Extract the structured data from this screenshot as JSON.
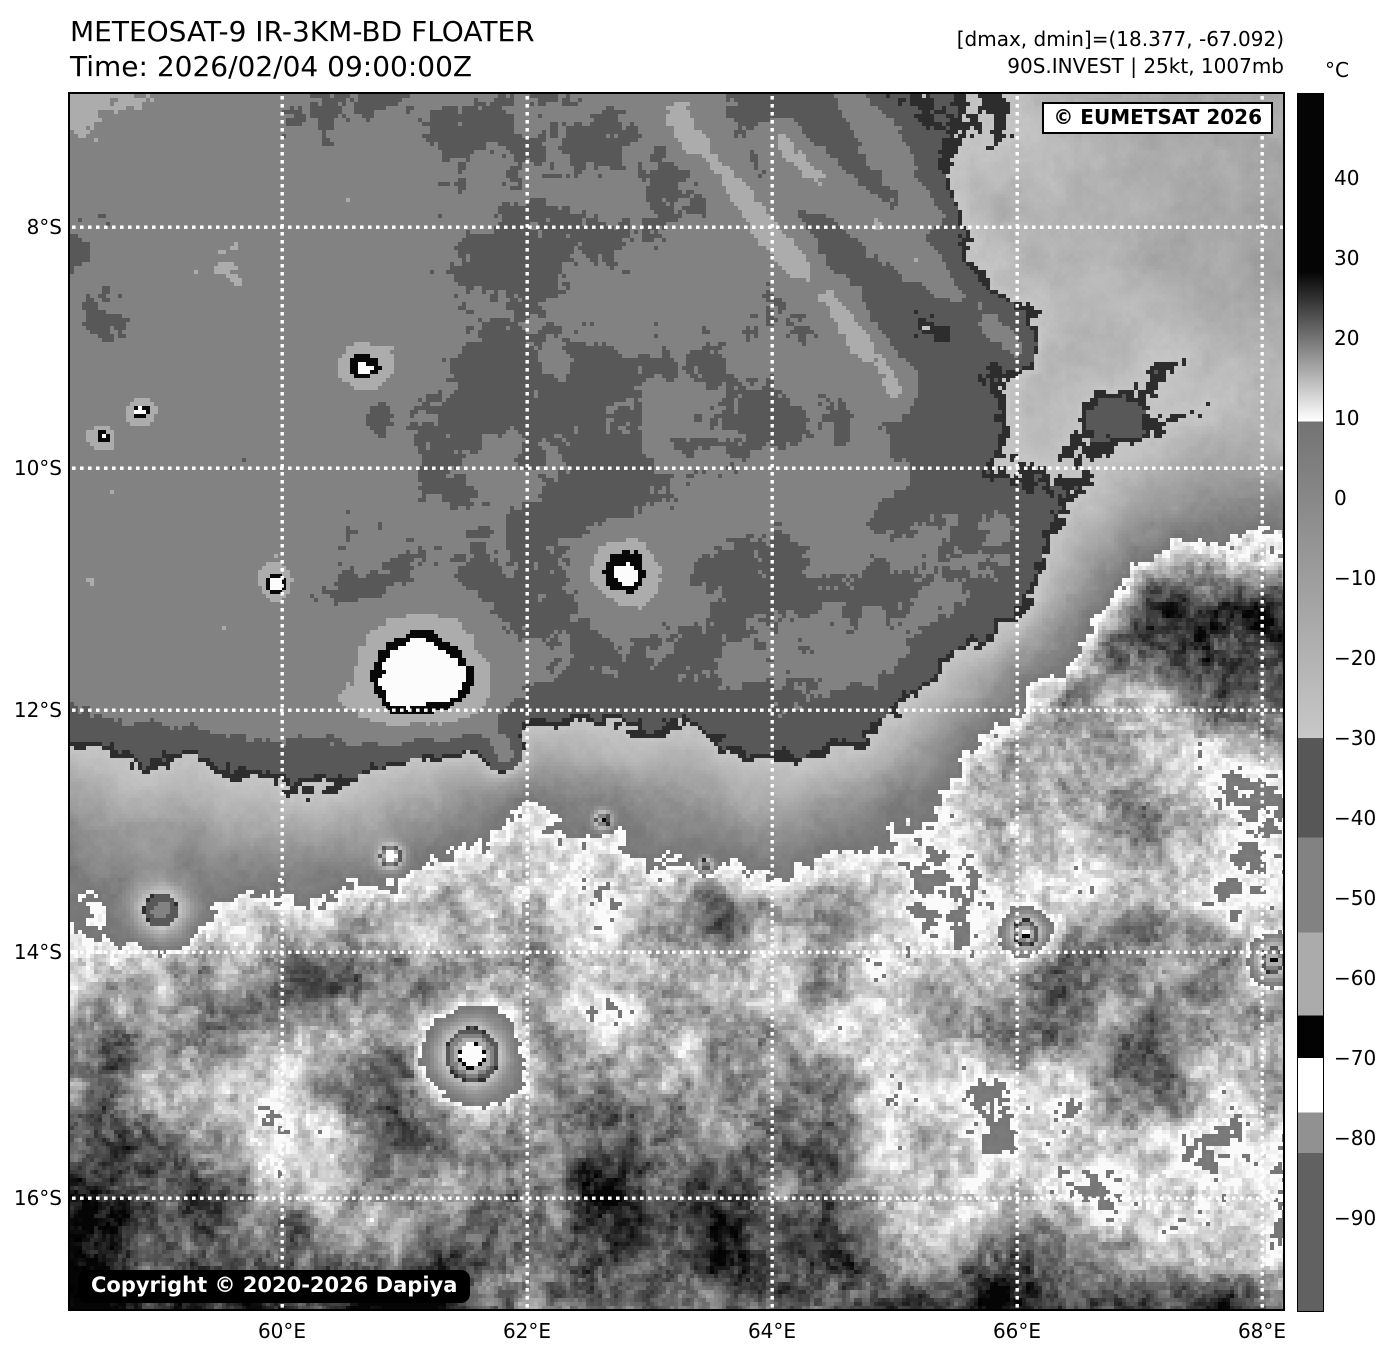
{
  "header": {
    "title": "METEOSAT-9 IR-3KM-BD FLOATER",
    "time": "Time: 2026/02/04 09:00:00Z",
    "dminmax": "[dmax, dmin]=(18.377, -67.092)",
    "storm": "90S.INVEST | 25kt, 1007mb"
  },
  "map": {
    "watermark": "© EUMETSAT 2026",
    "copyright": "Copyright © 2020-2026 Dapiya",
    "grid_color": "#ffffff",
    "frame_color": "#000000",
    "lat_gridlines": [
      {
        "label": "8°S",
        "y": 227
      },
      {
        "label": "10°S",
        "y": 468
      },
      {
        "label": "12°S",
        "y": 710
      },
      {
        "label": "14°S",
        "y": 952
      },
      {
        "label": "16°S",
        "y": 1198
      }
    ],
    "lon_gridlines": [
      {
        "label": "60°E",
        "x": 282
      },
      {
        "label": "62°E",
        "x": 527
      },
      {
        "label": "64°E",
        "x": 772
      },
      {
        "label": "66°E",
        "x": 1017
      },
      {
        "label": "68°E",
        "x": 1262
      }
    ]
  },
  "colorbar": {
    "unit": "°C",
    "ticks": [
      {
        "label": "40",
        "y": 178
      },
      {
        "label": "30",
        "y": 258
      },
      {
        "label": "20",
        "y": 338
      },
      {
        "label": "10",
        "y": 418
      },
      {
        "label": "0",
        "y": 498
      },
      {
        "label": "−10",
        "y": 578
      },
      {
        "label": "−20",
        "y": 658
      },
      {
        "label": "−30",
        "y": 738
      },
      {
        "label": "−40",
        "y": 818
      },
      {
        "label": "−50",
        "y": 898
      },
      {
        "label": "−60",
        "y": 978
      },
      {
        "label": "−70",
        "y": 1058
      },
      {
        "label": "−80",
        "y": 1138
      },
      {
        "label": "−90",
        "y": 1218
      }
    ],
    "stops": [
      {
        "p": 0.0,
        "c": "#050505"
      },
      {
        "p": 0.146,
        "c": "#050505"
      },
      {
        "p": 0.269,
        "c": "#ffffff"
      },
      {
        "p": 0.269,
        "c": "#737373"
      },
      {
        "p": 0.529,
        "c": "#c8c8c8"
      },
      {
        "p": 0.529,
        "c": "#575757"
      },
      {
        "p": 0.611,
        "c": "#575757"
      },
      {
        "p": 0.611,
        "c": "#828282"
      },
      {
        "p": 0.689,
        "c": "#828282"
      },
      {
        "p": 0.689,
        "c": "#ababab"
      },
      {
        "p": 0.757,
        "c": "#ababab"
      },
      {
        "p": 0.757,
        "c": "#030303"
      },
      {
        "p": 0.792,
        "c": "#030303"
      },
      {
        "p": 0.792,
        "c": "#ffffff"
      },
      {
        "p": 0.837,
        "c": "#ffffff"
      },
      {
        "p": 0.837,
        "c": "#919191"
      },
      {
        "p": 0.87,
        "c": "#919191"
      },
      {
        "p": 0.87,
        "c": "#616161"
      },
      {
        "p": 1.0,
        "c": "#616161"
      }
    ]
  }
}
